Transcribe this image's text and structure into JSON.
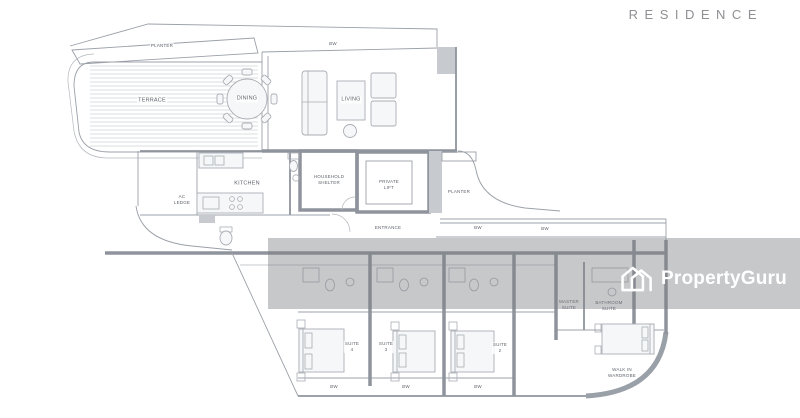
{
  "page": {
    "title": "RESIDENCE"
  },
  "watermark": {
    "brand": "PropertyGuru",
    "logo": "propertyguru-house-icon"
  },
  "floorplan": {
    "labels": {
      "planter_top": "PLANTER",
      "bw_top": "BW",
      "terrace": "TERRACE",
      "dining": "DINING",
      "living": "LIVING",
      "ac_ledge": "AC\nLEDGE",
      "kitchen": "KITCHEN",
      "household_shelter": "HOUSEHOLD\nSHELTER",
      "private_lift": "PRIVATE\nLIFT",
      "planter_right": "PLANTER",
      "entrance": "ENTRANCE",
      "bw_mid_1": "BW",
      "bw_mid_2": "BW",
      "suite_4": "SUITE\n4",
      "suite_3": "SUITE\n3",
      "suite_2": "SUITE\n2",
      "master_suite": "MASTER\nSUITE",
      "bathroom_suite": "BATHROOM\nSUITE",
      "walk_in_wardrobe": "WALK IN\nWARDROBE",
      "bw_bottom_1": "BW",
      "bw_bottom_2": "BW",
      "bw_bottom_3": "BW"
    },
    "colors": {
      "line": "#9ba0a8",
      "wall": "#8f949c",
      "wall_fill": "#c7cacf",
      "label_text": "#5f646c",
      "watermark_band": "rgba(122,124,128,0.42)",
      "watermark_text": "#ffffff",
      "title_text": "#8e9094"
    }
  }
}
